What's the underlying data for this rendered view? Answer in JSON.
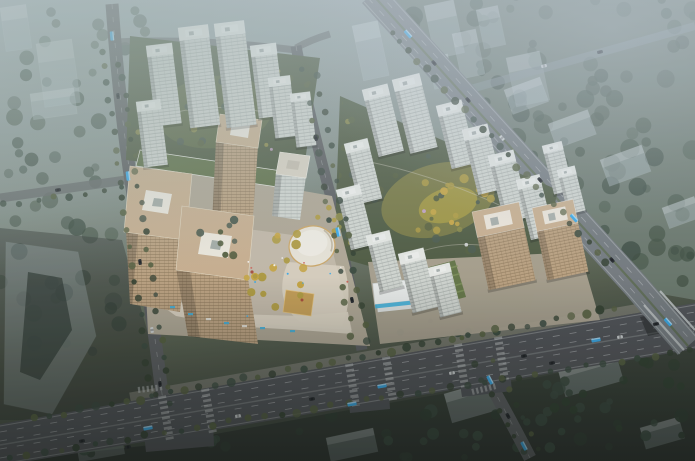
{
  "meta": {
    "type": "architectural-aerial-rendering",
    "subject": "Bird's-eye dusk rendering of a mixed-use urban development with residential clusters, commercial towers, boulevard and highway",
    "visible_text": "none"
  },
  "palette": {
    "bgTop": "#a3b0b4",
    "bgMid": "#7f8b84",
    "bgBottom": "#394038",
    "forestBase": "#6b786c",
    "treeDark": "#3a4a3e",
    "treeMid": "#4c5b4d",
    "treeOlive": "#555f3e",
    "treeYellow": "#b29d41",
    "treeLime": "#8e8c48",
    "roadMain": "#5c5e60",
    "roadMinor": "#686c6c",
    "boulevard": "#515357",
    "laneWhite": "#caccce",
    "highway": "#767c80",
    "highwayMedian": "#606e53",
    "bridgeRail": "#bac0c0",
    "sidewalk": "#8e8b80",
    "resFacade": "#d6dad4",
    "resLines": "#a9b0aa",
    "resRoof": "#eaece7",
    "tanRoof": "#ccb291",
    "tanFacade": "#bfa482",
    "tanLines": "#8a7355",
    "tanInner": "#f2ede1",
    "plazaLight": "#c9c0af",
    "plazaMid": "#b2a996",
    "podium": "#ded6c4",
    "greenPlot": "#4f5b41",
    "greenCourt": "#5e6a45",
    "greenRoof": "#5f7046",
    "ovalFill": "#ece7da",
    "ovalRing": "#d0aa68",
    "goldCanopy": "#c8a056",
    "canopyWhite": "#eff1ef",
    "canopyBlue": "#3fb0dc",
    "ghost": "#b7c4c9",
    "busBlue": "#3aacec",
    "carDark": "#26292d",
    "carWhite": "#d2d5d6",
    "accentRed": "#a84536",
    "accentPink": "#c4a3c6"
  },
  "regions": [
    {
      "name": "residential-cluster-north",
      "label": "White residential high-rise cluster around green courtyard"
    },
    {
      "name": "residential-cluster-east",
      "label": "White residential towers with yellow-green central garden"
    },
    {
      "name": "commercial-complex",
      "label": "Tan office towers, retail podium, oval pavilion, gold canopy"
    },
    {
      "name": "tan-apartment-towers",
      "label": "Two tan mid-rise towers near boulevard"
    },
    {
      "name": "sales-center",
      "label": "White canopy pavilion with cyan glazing"
    },
    {
      "name": "main-boulevard",
      "label": "Wide multi-lane boulevard lined with street trees"
    },
    {
      "name": "elevated-highway",
      "label": "Diagonal highway crossing boulevard on an overpass"
    },
    {
      "name": "forest-park",
      "label": "Dense hazy woodland north-east of highway"
    },
    {
      "name": "ghost-context-buildings",
      "label": "Translucent massing of surrounding city blocks"
    },
    {
      "name": "west-road",
      "label": "North-south access road on west side"
    },
    {
      "name": "internal-road",
      "label": "Internal north-south road between plots"
    },
    {
      "name": "vehicles",
      "label": "Cyan buses and dark/white cars on roads"
    }
  ]
}
